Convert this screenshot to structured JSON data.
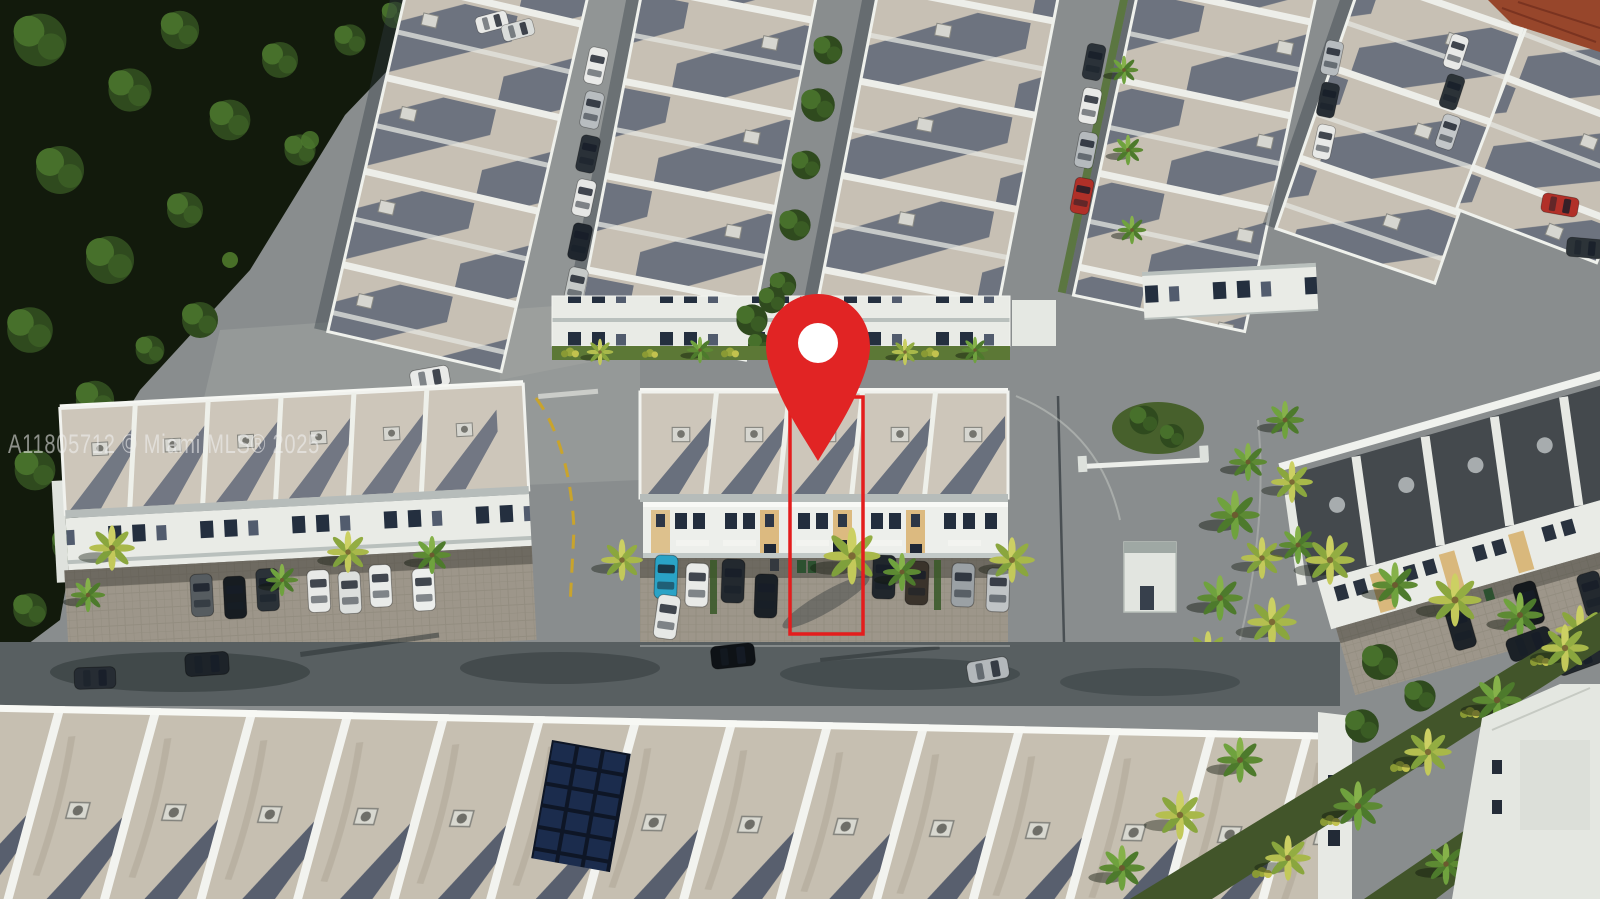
{
  "image": {
    "kind": "aerial-drone-photograph",
    "subject": "Townhome community with highlighted listing unit",
    "width_px": 1600,
    "height_px": 899
  },
  "watermark": {
    "text": "A11805712 © Miami MLS® 2025",
    "color": "#f2f2f2",
    "opacity": 0.55
  },
  "marker": {
    "icon": "map-pin-icon",
    "fill": "#e12424",
    "inner_fill": "#ffffff"
  },
  "highlight_outline": {
    "stroke": "#e41d1d",
    "stroke_width": 3.5
  },
  "palette": {
    "pavement": "#898d8e",
    "pavement_shadow": "#585f61",
    "roof_light": "#cdc6ba",
    "roof_shadow_band": "#36445f",
    "roof_dark": "#44494d",
    "facade_white": "#edefeb",
    "window_dark": "#232e3e",
    "accent_tan": "#dcba80",
    "forest_green": "#121a0c",
    "tree_green": "#3f6626",
    "palm_green": "#5d8a33",
    "palm_sunlit": "#c3c95a",
    "grass": "#5c7836",
    "terracotta_roof": "#97462b",
    "solar_panel": "#1b2c4d",
    "paver": "#9d968a",
    "marker_red": "#e12424"
  }
}
